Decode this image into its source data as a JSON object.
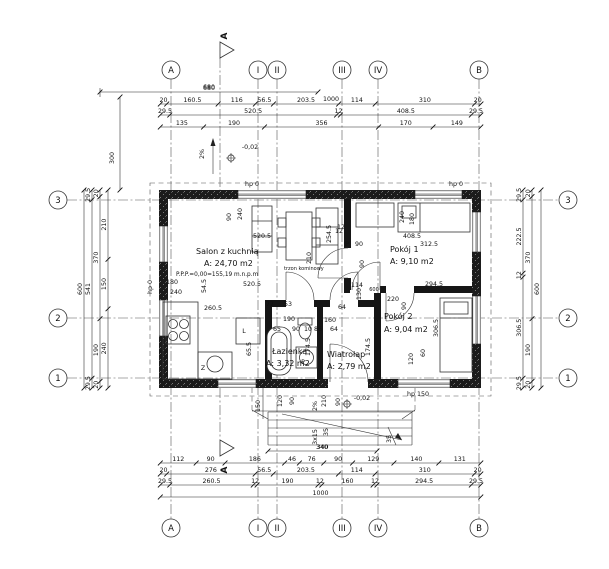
{
  "plan": {
    "section_label": "A",
    "rooms": [
      {
        "name": "Salon z kuchnią",
        "area": "A: 24,70 m2",
        "level_note": "P.P.P.=0,00=155,19 m.n.p.m"
      },
      {
        "name": "Pokój 1",
        "area": "A: 9,10 m2"
      },
      {
        "name": "Pokój 2",
        "area": "A: 9,04 m2"
      },
      {
        "name": "Łazienka",
        "area": "A: 3,32 m2"
      },
      {
        "name": "Wiatrołap",
        "area": "A: 2,79 m2"
      }
    ],
    "axes": {
      "top": [
        "A",
        "I",
        "II",
        "III",
        "IV",
        "B"
      ],
      "bottom": [
        "A",
        "I",
        "II",
        "III",
        "IV",
        "B"
      ],
      "left": [
        "3",
        "2",
        "1"
      ],
      "right": [
        "3",
        "2",
        "1"
      ]
    },
    "dim_chains": {
      "top0": [
        "680"
      ],
      "top1": [
        "20",
        "160.5",
        "116",
        "56.5",
        "203.5",
        "114",
        "310",
        "20"
      ],
      "top2": [
        "29.5",
        "520.5",
        "12",
        "408.5",
        "29.5"
      ],
      "top3": [
        "135",
        "190",
        "356",
        "170",
        "149"
      ],
      "porch": [
        "340"
      ],
      "bot1": [
        "112",
        "90",
        "186",
        "46",
        "76",
        "90",
        "129",
        "140",
        "131"
      ],
      "bot2": [
        "20",
        "276",
        "56.5",
        "203.5",
        "114",
        "310",
        "20"
      ],
      "bot3": [
        "29.5",
        "260.5",
        "12",
        "190",
        "12",
        "160",
        "12",
        "294.5",
        "29.5"
      ],
      "bot4": [
        "1000"
      ],
      "left0": [
        "600"
      ],
      "left1": [
        "29.5",
        "541",
        "29.5"
      ],
      "left2": [
        "20",
        "370",
        "190",
        "20"
      ],
      "left3": [
        "210",
        "150",
        "240"
      ],
      "right1": [
        "29.5",
        "222.5",
        "12",
        "306.5",
        "29.5"
      ],
      "right2": [
        "20",
        "370",
        "190",
        "20"
      ],
      "right3": [
        "600"
      ]
    },
    "labels": [
      {
        "t": "680",
        "x": 209,
        "y": 89
      },
      {
        "t": "1000",
        "x": 331,
        "y": 101
      },
      {
        "t": "-0,02",
        "x": 250,
        "y": 149
      },
      {
        "t": "2%",
        "x": 204,
        "y": 154,
        "r": -90
      },
      {
        "t": "300",
        "x": 114,
        "y": 158,
        "r": -90
      },
      {
        "t": "hp 0",
        "x": 252,
        "y": 186
      },
      {
        "t": "hp 0",
        "x": 456,
        "y": 186
      },
      {
        "t": "90",
        "x": 231,
        "y": 217,
        "r": -90
      },
      {
        "t": "240",
        "x": 242,
        "y": 214,
        "r": -90
      },
      {
        "t": "520.5",
        "x": 262,
        "y": 238
      },
      {
        "t": "12",
        "x": 341,
        "y": 229
      },
      {
        "t": "254.5",
        "x": 331,
        "y": 234,
        "r": -90
      },
      {
        "bind": "plan.rooms.0.name",
        "x": 196,
        "y": 254,
        "cls": "room",
        "a": "start",
        "nm": "room-name-salon"
      },
      {
        "bind": "plan.rooms.0.area",
        "x": 204,
        "y": 266,
        "cls": "room",
        "a": "start",
        "nm": "room-area-salon"
      },
      {
        "bind": "plan.rooms.0.level_note",
        "x": 176,
        "y": 276,
        "cls": "small",
        "a": "start",
        "nm": "floor-level-note"
      },
      {
        "t": "180",
        "x": 172,
        "y": 284
      },
      {
        "t": "54.5",
        "x": 206,
        "y": 286,
        "r": -90
      },
      {
        "t": "520.5",
        "x": 252,
        "y": 286
      },
      {
        "t": "240",
        "x": 176,
        "y": 294
      },
      {
        "t": "trzon kominowy",
        "x": 284,
        "y": 270,
        "cls": "tiny",
        "a": "start"
      },
      {
        "t": "hp 0",
        "x": 152,
        "y": 287,
        "r": -90
      },
      {
        "t": "260.5",
        "x": 213,
        "y": 310
      },
      {
        "t": "240",
        "x": 404,
        "y": 217,
        "r": -90
      },
      {
        "t": "180",
        "x": 414,
        "y": 219,
        "r": -90
      },
      {
        "t": "408.5",
        "x": 412,
        "y": 238
      },
      {
        "t": "312.5",
        "x": 429,
        "y": 246
      },
      {
        "bind": "plan.rooms.1.name",
        "x": 390,
        "y": 252,
        "cls": "room",
        "a": "start",
        "nm": "room-name-pokoj1"
      },
      {
        "bind": "plan.rooms.1.area",
        "x": 390,
        "y": 264,
        "cls": "room",
        "a": "start",
        "nm": "room-area-pokoj1"
      },
      {
        "t": "12",
        "x": 339,
        "y": 233
      },
      {
        "t": "P",
        "x": 347,
        "y": 246
      },
      {
        "t": "90",
        "x": 359,
        "y": 246
      },
      {
        "t": "210",
        "x": 311,
        "y": 258,
        "r": -90
      },
      {
        "t": "90",
        "x": 364,
        "y": 264,
        "r": -90
      },
      {
        "t": "114",
        "x": 357,
        "y": 287
      },
      {
        "t": "130",
        "x": 361,
        "y": 294,
        "r": -90
      },
      {
        "t": "600",
        "x": 374,
        "y": 291,
        "cls": "tiny"
      },
      {
        "t": "220",
        "x": 393,
        "y": 301
      },
      {
        "t": "90",
        "x": 406,
        "y": 306,
        "r": -90
      },
      {
        "t": "294.5",
        "x": 434,
        "y": 286
      },
      {
        "bind": "plan.rooms.2.name",
        "x": 384,
        "y": 319,
        "cls": "room",
        "a": "start",
        "nm": "room-name-pokoj2"
      },
      {
        "bind": "plan.rooms.2.area",
        "x": 384,
        "y": 332,
        "cls": "room",
        "a": "start",
        "nm": "room-area-pokoj2"
      },
      {
        "t": "306.5",
        "x": 438,
        "y": 328,
        "r": -90
      },
      {
        "t": "120",
        "x": 413,
        "y": 359,
        "r": -90
      },
      {
        "t": "60",
        "x": 425,
        "y": 353,
        "r": -90
      },
      {
        "t": "hp 150",
        "x": 418,
        "y": 396
      },
      {
        "t": "77",
        "x": 270,
        "y": 306
      },
      {
        "t": "53",
        "x": 288,
        "y": 306
      },
      {
        "t": "64",
        "x": 342,
        "y": 309
      },
      {
        "t": "190",
        "x": 289,
        "y": 321
      },
      {
        "t": "160",
        "x": 330,
        "y": 322
      },
      {
        "t": "65",
        "x": 277,
        "y": 331
      },
      {
        "t": "90",
        "x": 296,
        "y": 331
      },
      {
        "t": "10",
        "x": 308,
        "y": 331
      },
      {
        "t": "86",
        "x": 318,
        "y": 331
      },
      {
        "t": "64",
        "x": 334,
        "y": 331
      },
      {
        "t": "174.5",
        "x": 310,
        "y": 347,
        "r": -90
      },
      {
        "t": "174.5",
        "x": 370,
        "y": 347,
        "r": -90
      },
      {
        "bind": "plan.rooms.3.name",
        "x": 272,
        "y": 354,
        "cls": "room",
        "a": "start",
        "nm": "room-name-lazienka"
      },
      {
        "bind": "plan.rooms.3.area",
        "x": 266,
        "y": 366,
        "cls": "room",
        "a": "start",
        "nm": "room-area-lazienka"
      },
      {
        "bind": "plan.rooms.4.name",
        "x": 327,
        "y": 357,
        "cls": "room",
        "a": "start",
        "nm": "room-name-wiatrolap"
      },
      {
        "bind": "plan.rooms.4.area",
        "x": 327,
        "y": 369,
        "cls": "room",
        "a": "start",
        "nm": "room-area-wiatrolap"
      },
      {
        "t": "L",
        "x": 244,
        "y": 333
      },
      {
        "t": "Z",
        "x": 203,
        "y": 370
      },
      {
        "t": "P",
        "x": 303,
        "y": 364
      },
      {
        "t": "65.5",
        "x": 251,
        "y": 349,
        "r": -90
      },
      {
        "t": "150",
        "x": 260,
        "y": 406,
        "r": -90
      },
      {
        "t": "120",
        "x": 282,
        "y": 401,
        "r": -90
      },
      {
        "t": "90",
        "x": 294,
        "y": 401,
        "r": -90
      },
      {
        "t": "2%",
        "x": 317,
        "y": 406,
        "r": -90
      },
      {
        "t": "210",
        "x": 326,
        "y": 401,
        "r": -90
      },
      {
        "t": "90",
        "x": 340,
        "y": 402,
        "r": -90
      },
      {
        "t": "-0,02",
        "x": 362,
        "y": 400
      },
      {
        "t": "3x15",
        "x": 317,
        "y": 437,
        "r": -90
      },
      {
        "t": "35",
        "x": 328,
        "y": 432,
        "r": -90
      },
      {
        "t": "35",
        "x": 391,
        "y": 439,
        "r": -90
      },
      {
        "t": "340",
        "x": 322,
        "y": 449
      }
    ]
  }
}
